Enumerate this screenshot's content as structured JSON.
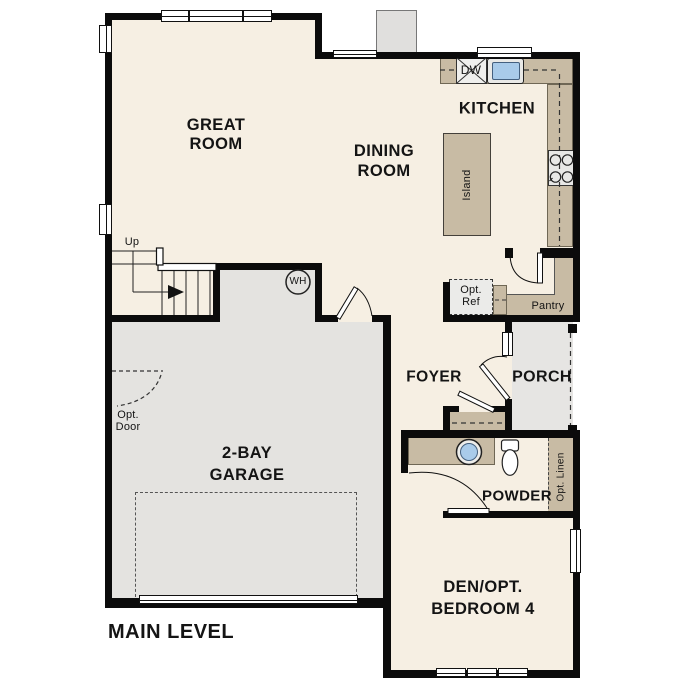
{
  "plan_title": "MAIN LEVEL",
  "rooms": {
    "great_room": {
      "line1": "GREAT",
      "line2": "ROOM"
    },
    "dining_room": {
      "line1": "DINING",
      "line2": "ROOM"
    },
    "kitchen": {
      "label": "KITCHEN"
    },
    "foyer": {
      "label": "FOYER"
    },
    "porch": {
      "label": "PORCH"
    },
    "garage": {
      "line1": "2-BAY",
      "line2": "GARAGE"
    },
    "powder_room": {
      "label": "POWDER"
    },
    "pantry": {
      "label": "Pantry"
    },
    "den": {
      "line1": "DEN/OPT.",
      "line2": "BEDROOM 4"
    }
  },
  "fixtures": {
    "island": {
      "label": "Island"
    },
    "dishwasher": {
      "label": "DW"
    },
    "water_heater": {
      "label": "WH"
    },
    "stairs": {
      "label": "Up"
    },
    "optional_refrigerator": {
      "line1": "Opt.",
      "line2": "Ref"
    },
    "optional_linen": {
      "label": "Opt. Linen"
    },
    "optional_door": {
      "line1": "Opt.",
      "line2": "Door"
    }
  },
  "colors": {
    "background": "#FFFFFF",
    "floor_cream": "#F6EFE3",
    "garage_gray": "#E4E3E0",
    "cabinet_tan": "#C8BBA4",
    "wall_black": "#0B0B0B",
    "sink_blue": "#A9CBEA",
    "appliance_gray": "#ECECEA"
  }
}
